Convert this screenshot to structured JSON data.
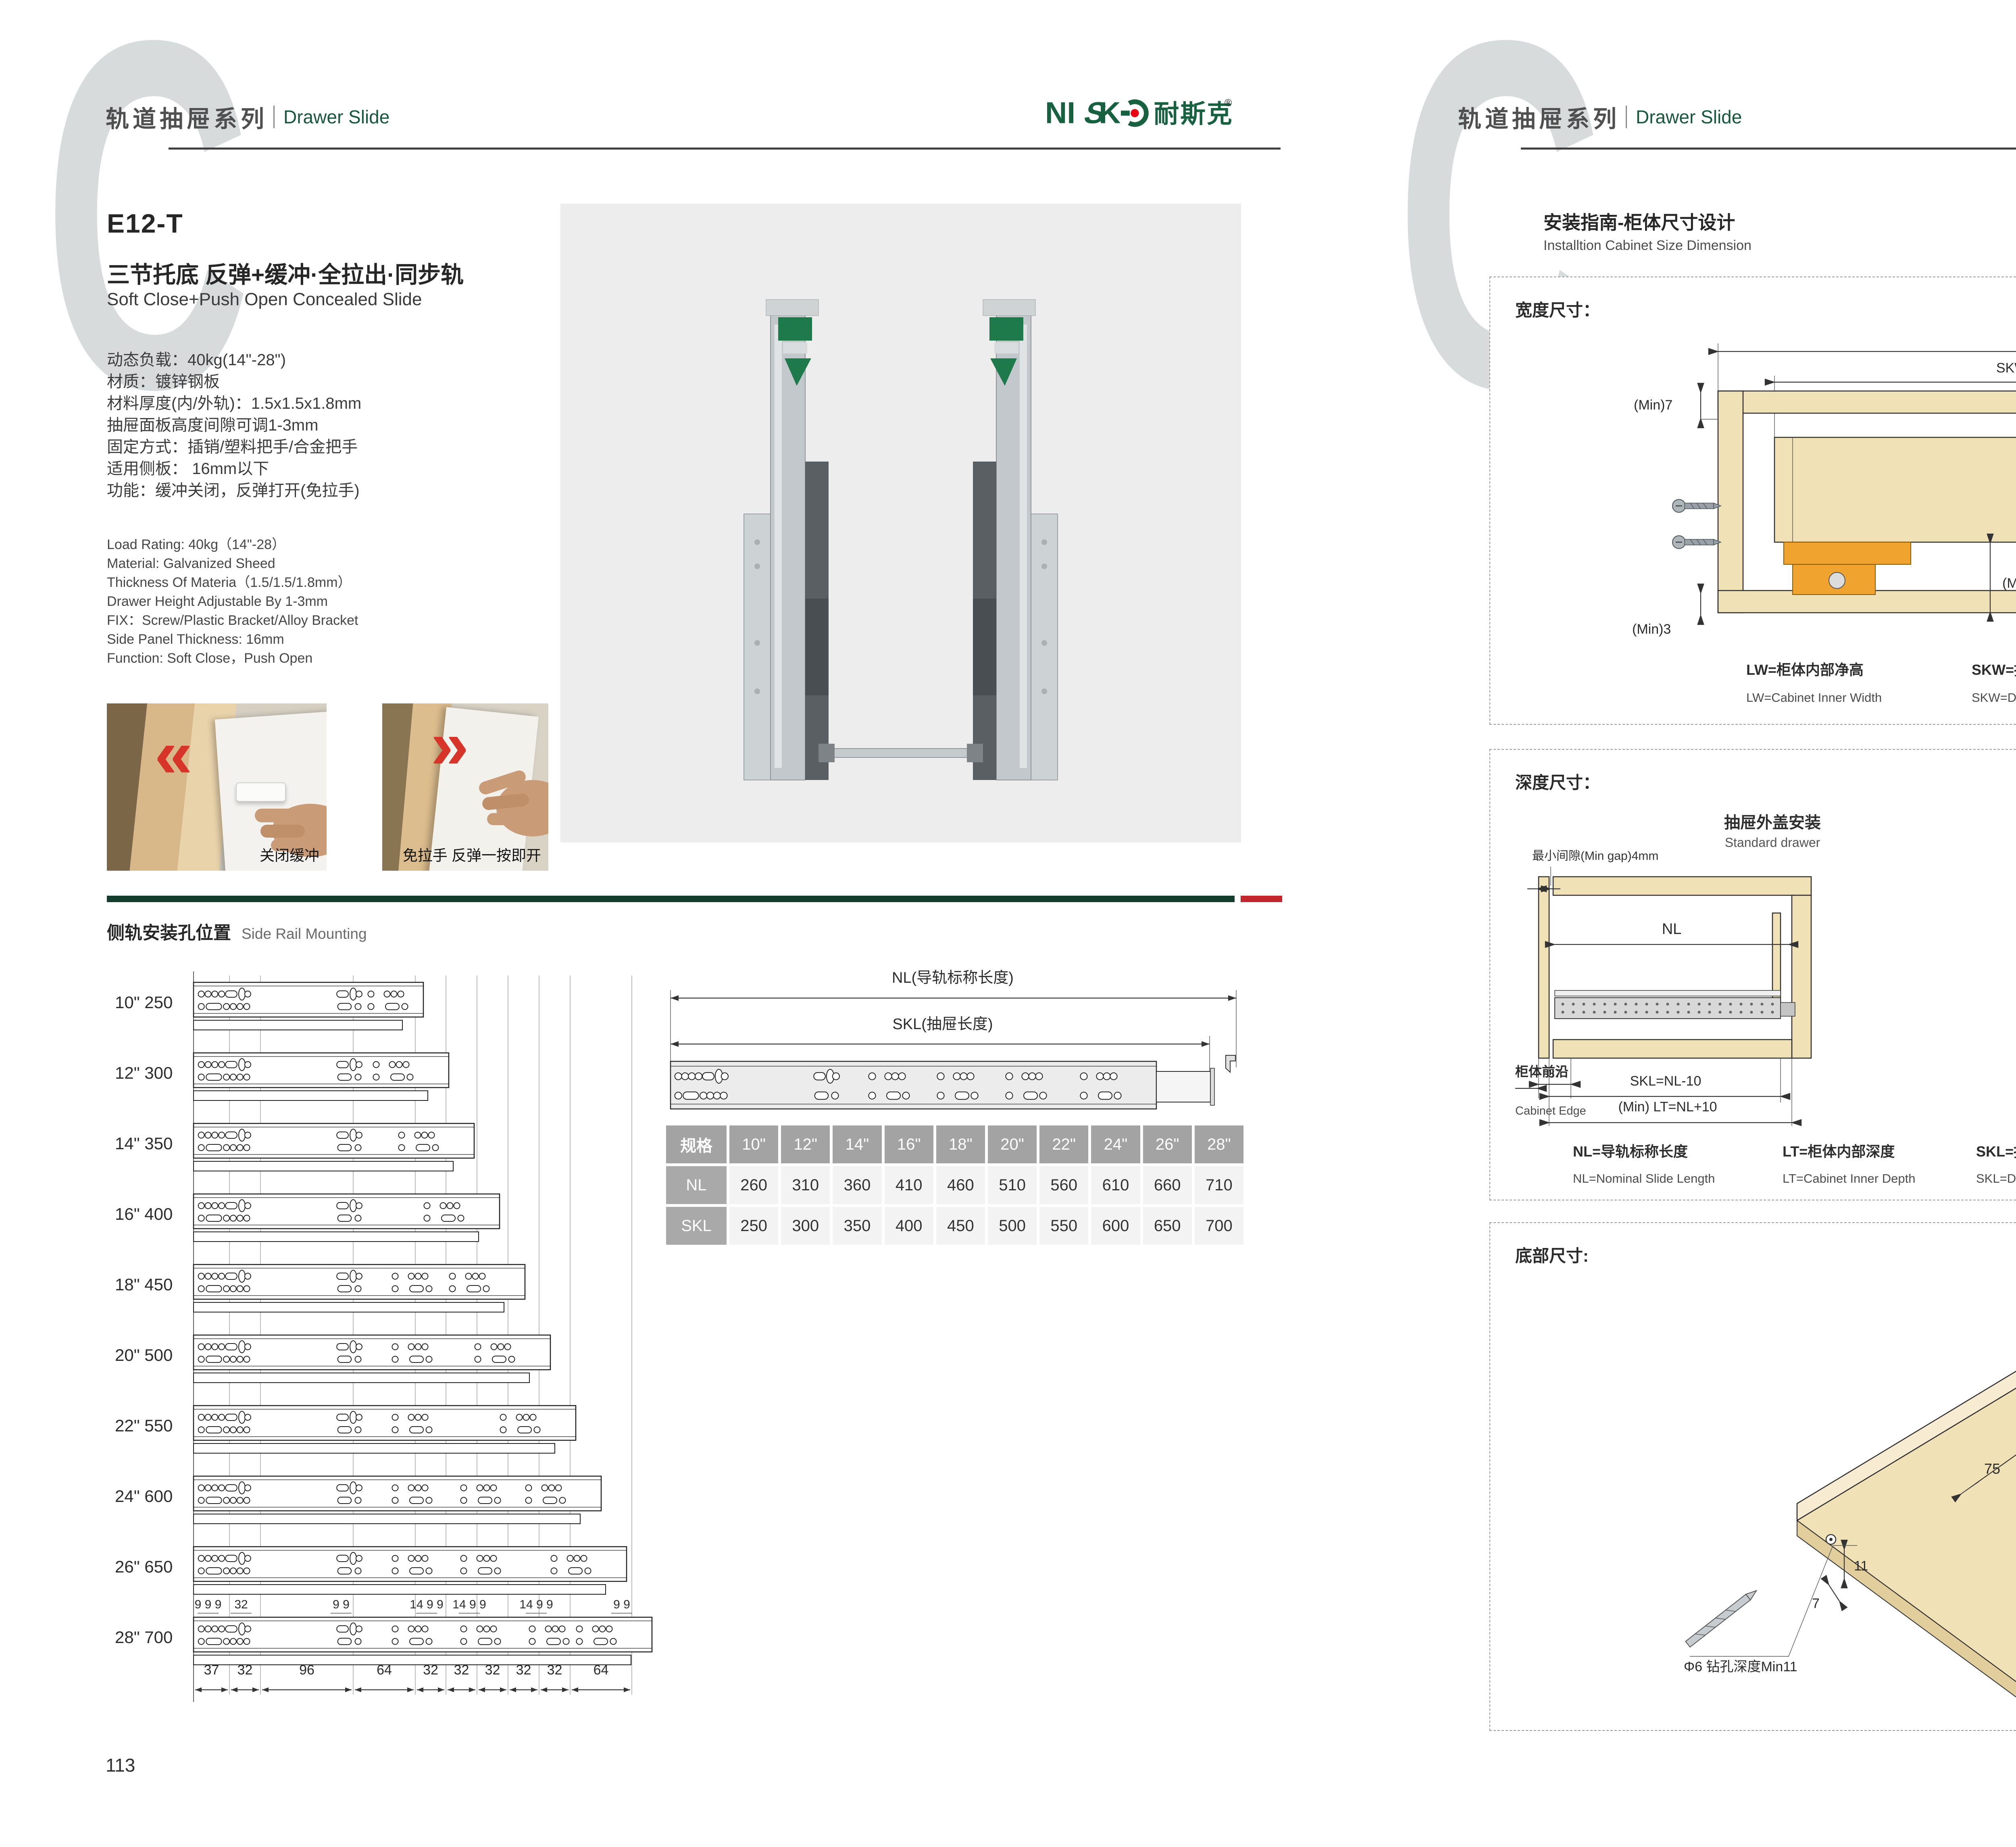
{
  "header": {
    "watermark": "C",
    "series_zh": "轨道抽屉系列",
    "series_en": "Drawer Slide",
    "logo_latin_1": "NI",
    "logo_latin_2": "S",
    "logo_latin_3": "K",
    "logo_cn": "耐斯克",
    "logo_reg": "®"
  },
  "colors": {
    "brand_green": "#176141",
    "logo_red": "#e60012",
    "divider_green": "#143d2e",
    "divider_red": "#c1272d",
    "wood": "#f1e1b6",
    "hardware_orange": "#f0a32e",
    "photo_bg": "#ededee"
  },
  "left_page": {
    "model": "E12-T",
    "title_zh": "三节托底 反弹+缓冲·全拉出·同步轨",
    "title_en": "Soft Close+Push Open Concealed Slide",
    "specs_zh": [
      "动态负载：40kg(14\"-28\")",
      "材质：镀锌钢板",
      "材料厚度(内/外轨)：1.5x1.5x1.8mm",
      "抽屉面板高度间隙可调1-3mm",
      "固定方式：插销/塑料把手/合金把手",
      "适用侧板： 16mm以下",
      "功能：缓冲关闭，反弹打开(免拉手)"
    ],
    "specs_en": [
      "Load Rating: 40kg（14\"-28）",
      "Material: Galvanized Sheed",
      "Thickness Of Materia（1.5/1.5/1.8mm）",
      "Drawer Height Adjustable By 1-3mm",
      "FIX：Screw/Plastic Bracket/Alloy Bracket",
      "Side Panel Thickness: 16mm",
      "Function: Soft Close，Push Open"
    ],
    "photo_captions": [
      "关闭缓冲",
      "免拉手 反弹一按即开"
    ],
    "section_title_zh": "侧轨安装孔位置",
    "section_title_en": "Side Rail Mounting",
    "rails": {
      "rows": [
        {
          "label": "10\" 250",
          "skl": 250
        },
        {
          "label": "12\" 300",
          "skl": 300
        },
        {
          "label": "14\" 350",
          "skl": 350
        },
        {
          "label": "16\" 400",
          "skl": 400
        },
        {
          "label": "18\" 450",
          "skl": 450
        },
        {
          "label": "20\" 500",
          "skl": 500
        },
        {
          "label": "22\" 550",
          "skl": 550
        },
        {
          "label": "24\" 600",
          "skl": 600
        },
        {
          "label": "26\" 650",
          "skl": 650
        },
        {
          "label": "28\" 700",
          "skl": 700
        }
      ],
      "top_dims": [
        "9 9 9",
        "32",
        "9 9",
        "14 9 9",
        "14 9 9",
        "14 9 9",
        "9 9"
      ],
      "bottom_dims": [
        "37",
        "32",
        "96",
        "64",
        "32",
        "32",
        "32",
        "32",
        "32",
        "64"
      ]
    },
    "slide_diagram": {
      "nl": "NL(导轨标称长度)",
      "skl": "SKL(抽屉长度)"
    },
    "size_table": {
      "header": [
        "规格",
        "10\"",
        "12\"",
        "14\"",
        "16\"",
        "18\"",
        "20\"",
        "22\"",
        "24\"",
        "26\"",
        "28\""
      ],
      "rows": [
        {
          "label": "NL",
          "values": [
            "260",
            "310",
            "360",
            "410",
            "460",
            "510",
            "560",
            "610",
            "660",
            "710"
          ]
        },
        {
          "label": "SKL",
          "values": [
            "250",
            "300",
            "350",
            "400",
            "450",
            "500",
            "550",
            "600",
            "650",
            "700"
          ]
        }
      ]
    },
    "page_number": "113"
  },
  "right_page": {
    "section_title_zh": "安装指南-柜体尺寸设计",
    "section_title_en": "Installtion Cabinet Size Dimension",
    "width_box": {
      "title": "宽度尺寸：",
      "dims": {
        "lw": "LW",
        "skw": "SKW=LW-42",
        "min7": "(Min)7",
        "max16": "(Max)16",
        "d12": "12",
        "d10": "10",
        "d37": "37",
        "min275": "(Min)27.5",
        "min3": "(Min)3",
        "d21": "21"
      },
      "legend": [
        {
          "zh": "LW=柜体内部净高",
          "en": "LW=Cabinet Inner Width"
        },
        {
          "zh": "SKW=抽屉宽度",
          "en": "SKW=Drawer  Width"
        },
        {
          "zh": "最大尺寸",
          "en": "Max"
        },
        {
          "zh": "最小尺寸",
          "en": "Min"
        }
      ]
    },
    "depth_box": {
      "title": "深度尺寸：",
      "min_gap": "最小间隙(Min gap)4mm",
      "standard": {
        "zh": "抽屉外盖安装",
        "en": "Standard drawer",
        "nl": "NL",
        "d37": "37",
        "edge_zh": "柜体前沿",
        "edge_en": "Cabinet Edge",
        "skl": "SKL=NL-10",
        "lt": "(Min) LT=NL+10"
      },
      "builtin": {
        "zh": "抽屉内置安装",
        "en": "Built-in drawer",
        "nl": "NL",
        "x": "X",
        "edge_zh": "柜体前沿",
        "edge_en": "Cabinet Edge",
        "iskl": "ISKL=SKL+X",
        "lt": "(Min) LT=NL+X+10"
      },
      "legend": [
        {
          "zh": "NL=导轨标称长度",
          "en": "NL=Nominal Slide Length"
        },
        {
          "zh": "LT=柜体内部深度",
          "en": "LT=Cabinet Inner Depth"
        },
        {
          "zh": "SKL=抽屉长度",
          "en": "SKL=Drawer Length"
        },
        {
          "zh": "ISKL=内抽屉长度",
          "en": "ISKL=Drawer Inner Length"
        },
        {
          "zh": "X=抽屉面板厚度",
          "en": "X=Drawer Panel Thickness"
        }
      ]
    },
    "bottom_box": {
      "title": "底部尺寸:",
      "d75": "75",
      "d85": "85",
      "d11": "11",
      "d7": "7",
      "hole_note": "Φ6 钻孔深度Min11",
      "diag_note": "抽屉长度SKL=导轨标称长度NL-10"
    },
    "page_number": "114"
  }
}
